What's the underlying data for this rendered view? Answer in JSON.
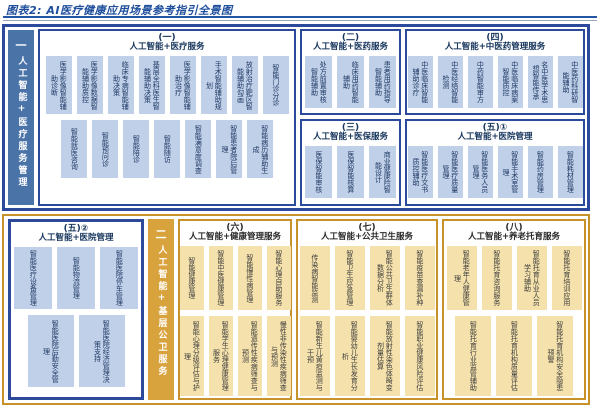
{
  "title": "图表2: AI医疗健康应用场景参考指引全景图",
  "colors": {
    "title_blue": "#1f4e9c",
    "blue_border": "#2b4a9b",
    "blue_sidebar": "#4a73a8",
    "blue_tile": "#bfd0e8",
    "blue_tile_text": "#1f3864",
    "gold_border": "#c8922a",
    "gold_sidebar": "#d8a33c",
    "gold_tile": "#f4e1ab"
  },
  "top_region": {
    "sidebar": {
      "number": "一",
      "label": "人工智能+医疗服务管理"
    },
    "boxes": [
      {
        "number": "(一)",
        "title": "人工智能+医疗服务",
        "rows": [
          [
            "医学影像智能辅助诊断",
            "医学影像数据智能辅助质控",
            "临床专病智能辅助决策",
            "基层全科医生智能辅助决策",
            "医学影像智能辅助治疗",
            "手术智能辅助规划",
            "放射治疗靶区智能辅助勾画",
            "智能门诊分诊"
          ],
          [
            "智能就医咨询",
            "智能预问诊",
            "智能陪诊",
            "智能随访",
            "智能满意度调查",
            "智能患者院后管理",
            "智能病历辅助生成"
          ]
        ]
      },
      {
        "number": "(二)",
        "title": "人工智能+医药服务",
        "rows": [
          [
            "处方前置审核智能辅助",
            "临床用药智能辅助",
            "患者用药指导智能辅助"
          ]
        ]
      },
      {
        "number": "(三)",
        "title": "人工智能+医保服务",
        "rows": [
          [
            "医保智能审核",
            "医保智能核算",
            "商业健康险智能设计"
          ]
        ]
      },
      {
        "number": "(四)",
        "title": "人工智能+中医药管理服务",
        "rows": [
          [
            "中医临床智能辅助诊疗",
            "中医经络智能检测",
            "中药智能审方",
            "中医临床病案智能质控",
            "名中医学术思想智能传承",
            "中医药科研智能辅助"
          ]
        ]
      },
      {
        "number": "(五)①",
        "title": "人工智能+医院管理",
        "rows": [
          [
            "智能医疗文书质控辅助",
            "智能医疗质量管理",
            "智能医务人员管理",
            "智能手术室管理",
            "智能药房管理",
            "智能耗材管理"
          ]
        ]
      }
    ]
  },
  "bottom_region": {
    "sidebar": {
      "number": "二",
      "label": "人工智能+基层公卫服务"
    },
    "boxes": [
      {
        "number": "(五)②",
        "title": "人工智能+医院管理",
        "rows": [
          [
            "智能医疗设备管理",
            "智能物流管理",
            "智能医院停车管理"
          ],
          [
            "智能医院后勤安全管理",
            "智能医院经济管理决策支持"
          ]
        ]
      },
      {
        "number": "(六)",
        "title": "人工智能+健康管理服务",
        "rows": [
          [
            "智能健康管理",
            "智能中医健康管理",
            "智能慢性病管理",
            "智能心理自助服务"
          ],
          [
            "智能心理分级评估与护理",
            "智能学生心理健康管理服务",
            "智能遗传性疾病筛查与预测",
            "慢性非传染性疾病筛查与预测"
          ]
        ]
      },
      {
        "number": "(七)",
        "title": "人工智能+公共卫生服务",
        "rows": [
          [
            "传染病智能监测",
            "智能卫生应急管理",
            "智能公共卫生群体数据分析",
            "智能疫苗查漏补种"
          ],
          [
            "智能新生儿黄疸监测与干预",
            "智能婴幼儿生长发育分析",
            "智能放射性染色体畸变剂量估算",
            "智能职业健康风险评估"
          ]
        ]
      },
      {
        "number": "(八)",
        "title": "人工智能+养老托育服务",
        "rows": [
          [
            "智能老年人健康管理",
            "智能托育咨询服务",
            "智能托育从业人员学习辅助",
            "智能托育培训应用"
          ],
          [
            "智能托育行业监管辅助",
            "智能托育机构质量评估",
            "智能托育机构安全隐患预警"
          ]
        ]
      }
    ]
  }
}
